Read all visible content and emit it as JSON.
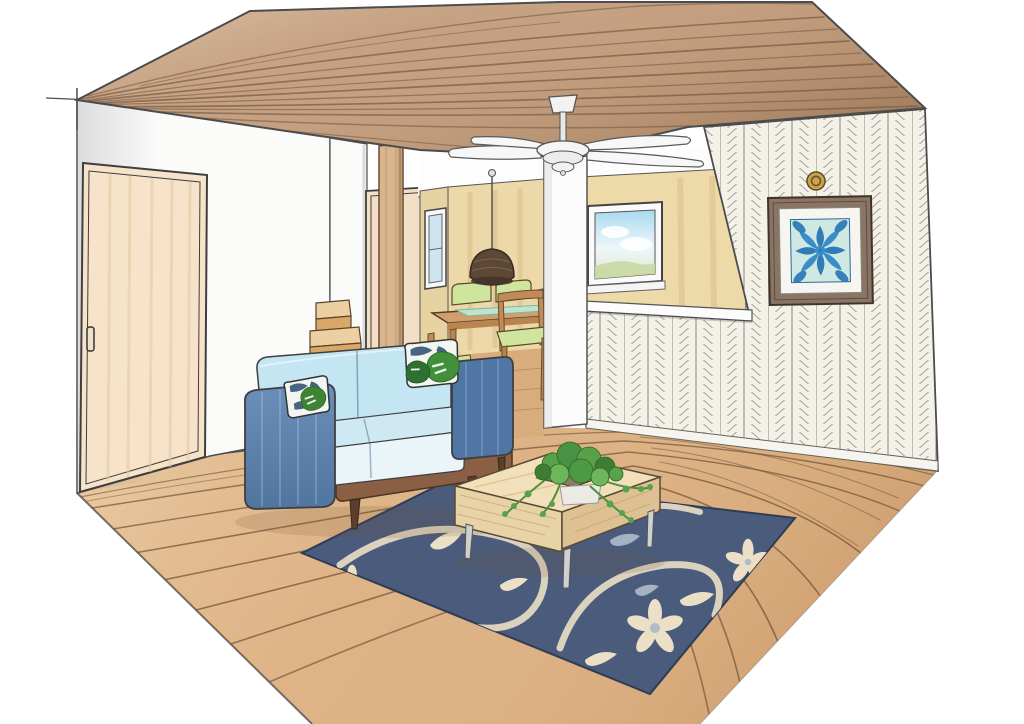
{
  "scene": {
    "type": "interior-illustration",
    "description": "hand-drawn watercolor perspective sketch of a living-dining room",
    "objects": [
      "wood-plank-ceiling",
      "ceiling-fan",
      "sliding-door",
      "left-wall",
      "staircase",
      "wood-post",
      "hallway-door",
      "dining-area",
      "pendant-lamp",
      "dining-table",
      "dining-chairs",
      "back-window",
      "narrow-window",
      "half-wall-counter",
      "herringbone-accent-wall",
      "hawaiian-quilt-art",
      "wall-medallion",
      "blue-sofa",
      "leaf-throw-pillows",
      "navy-floral-rug",
      "coffee-table",
      "trailing-plant",
      "wood-floor"
    ]
  },
  "colors": {
    "page_bg": "#ffffff",
    "ceiling_wood": "#c4a182",
    "ceiling_line": "#7a5a42",
    "floor_wood": "#ddb285",
    "floor_line": "#6f5236",
    "wall_white": "#fbfbfa",
    "wall_beige": "#ecd8a9",
    "wall_beige_side": "#e7d2a2",
    "door_cream": "#f6e3c9",
    "hall_door_cream": "#f2dfc6",
    "post_wood": "#d8b58d",
    "stair_tread": "#eccfa2",
    "stair_riser": "#d9a869",
    "herringbone_bg": "#f4f1e8",
    "sofa_arm_blue": "#5d84b1",
    "sofa_arm_dark": "#4f76a4",
    "sofa_back_blue": "#c4e5f2",
    "sofa_seat_top": "#cfe9f4",
    "sofa_seat_front": "#e9f5f9",
    "sofa_base_wood": "#8a5f43",
    "pillow_white": "#f2f5f2",
    "pillow_navy": "#2c4a6e",
    "leaf_green": "#3f8435",
    "rug_navy": "#4a5b7c",
    "rug_cream": "#ebdfc6",
    "rug_bluegrey": "#aebccb",
    "table_wood_light": "#f2e0ba",
    "table_leg_silver": "#d0d0d0",
    "plant_green": "#5aa04a",
    "dining_table_wood": "#cf9f6c",
    "chair_green": "#cfe49d",
    "runner_mint": "#bfe3cf",
    "pendant_brown": "#5d4836",
    "window_sky": "#a9d9ef",
    "art_frame_brown": "#8a7565",
    "quilt_bg": "#cfe9e2",
    "quilt_blue": "#2e7cb8",
    "quilt_blue_light": "#3a8ec8",
    "brass": "#c7a44e",
    "ink": "#4c4c4c"
  }
}
